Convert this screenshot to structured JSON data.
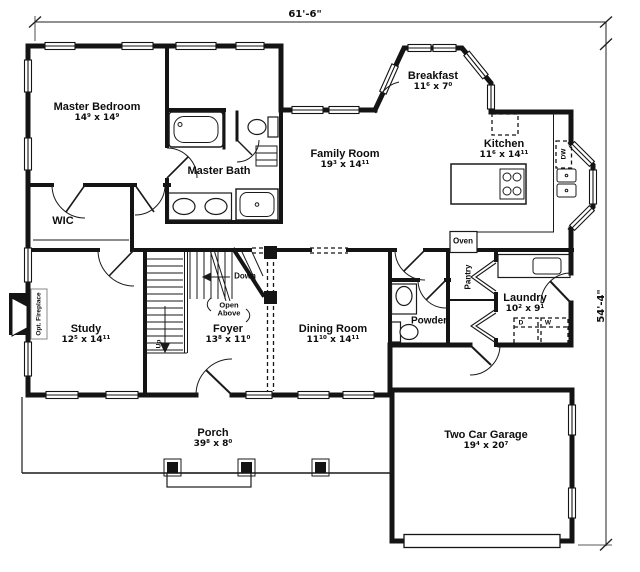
{
  "plan": {
    "overall_width": "61'-6\"",
    "overall_height": "54'-4\"",
    "rooms": [
      {
        "id": "master-bedroom",
        "name": "Master Bedroom",
        "dims": "14⁹ x 14⁹"
      },
      {
        "id": "master-bath",
        "name": "Master Bath",
        "dims": ""
      },
      {
        "id": "wic",
        "name": "WIC",
        "dims": ""
      },
      {
        "id": "family-room",
        "name": "Family Room",
        "dims": "19³ x 14¹¹"
      },
      {
        "id": "breakfast",
        "name": "Breakfast",
        "dims": "11⁶ x 7⁰"
      },
      {
        "id": "kitchen",
        "name": "Kitchen",
        "dims": "11⁶ x 14¹¹"
      },
      {
        "id": "laundry",
        "name": "Laundry",
        "dims": "10² x 9¹"
      },
      {
        "id": "powder",
        "name": "Powder",
        "dims": ""
      },
      {
        "id": "study",
        "name": "Study",
        "dims": "12⁵ x 14¹¹"
      },
      {
        "id": "foyer",
        "name": "Foyer",
        "dims": "13⁸ x 11⁰"
      },
      {
        "id": "dining-room",
        "name": "Dining Room",
        "dims": "11¹⁰ x 14¹¹"
      },
      {
        "id": "porch",
        "name": "Porch",
        "dims": "39⁸ x 8⁰"
      },
      {
        "id": "garage",
        "name": "Two Car Garage",
        "dims": "19⁴ x 20⁷"
      }
    ],
    "annotations": {
      "oven": "Oven",
      "pantry": "Pantry",
      "dishwasher": "DW",
      "dryer": "D",
      "washer": "W",
      "stairs_up": "Up",
      "stairs_down": "Down",
      "open_above_line1": "Open",
      "open_above_line2": "Above",
      "opt_fireplace": "Opt. Fireplace"
    }
  }
}
